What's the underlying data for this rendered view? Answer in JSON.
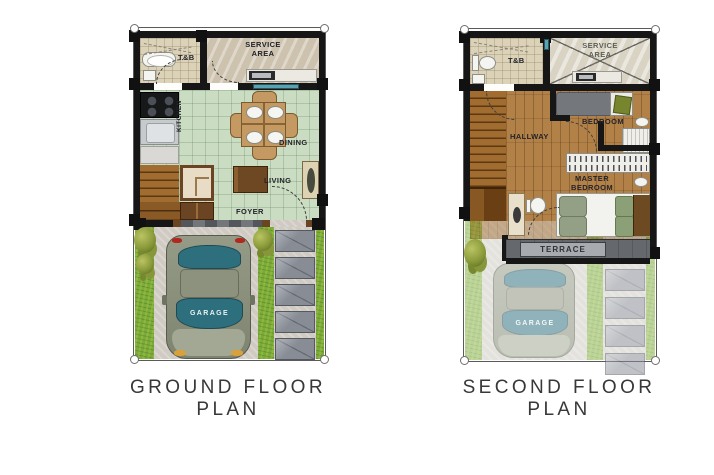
{
  "sheet": {
    "background": "#ffffff"
  },
  "ground_floor": {
    "title": "GROUND FLOOR PLAN",
    "labels": {
      "service_area": "SERVICE AREA",
      "toilet_bath": "T&B",
      "kitchen": "KITCHEN",
      "dining": "DINING",
      "living": "LIVING",
      "foyer": "FOYER",
      "garage": "GARAGE"
    }
  },
  "second_floor": {
    "title": "SECOND FLOOR PLAN",
    "labels": {
      "service_area": "SERVICE AREA",
      "toilet_bath": "T&B",
      "hallway": "HALLWAY",
      "bedroom": "BEDROOM",
      "master_bedroom": "MASTER BEDROOM",
      "terrace": "TERRACE",
      "garage": "GARAGE"
    }
  },
  "colors": {
    "wall": "#161616",
    "floor_tile_green": "#cadcc2",
    "floor_tile_beige": "#dbd2b8",
    "wood_stairs": "#a06c30",
    "wood_hall": "#b28148",
    "grass": "#7cab3b",
    "concrete": "#cfcbc2",
    "paver_gray": "#878c95",
    "window_glass": "#57a3b2",
    "car_body": "#8d927f",
    "car_glass": "#2e6f7e",
    "terrace_gray": "#65696d",
    "label_text": "#23232b",
    "title_text": "#383838"
  }
}
